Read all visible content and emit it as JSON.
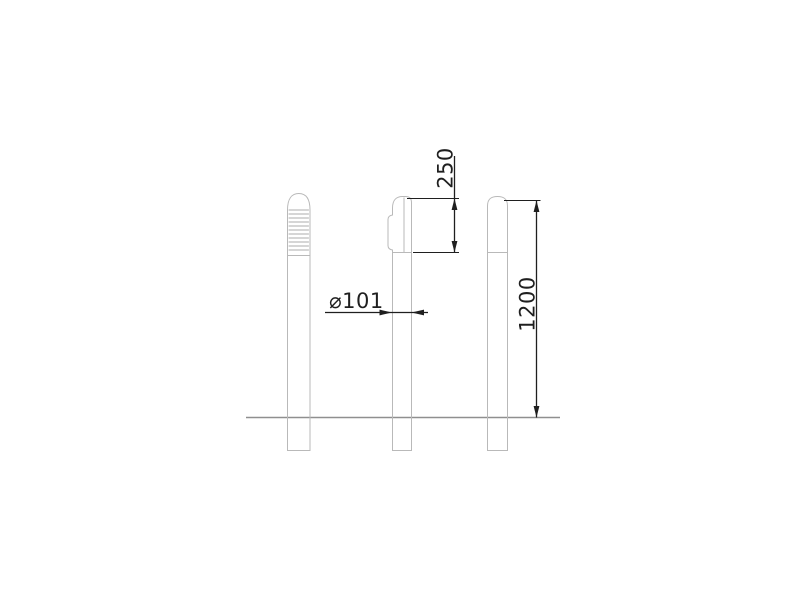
{
  "drawing": {
    "dim_cap_height": "250",
    "dim_diameter": "⌀101",
    "dim_post_height": "1200",
    "reflective_band": {
      "line_count": 11
    },
    "colors": {
      "outline": "#b9b9b9",
      "band_line": "#c9c9c9",
      "ground": "#8f8f8f",
      "dimension": "#1f1f1f"
    }
  }
}
